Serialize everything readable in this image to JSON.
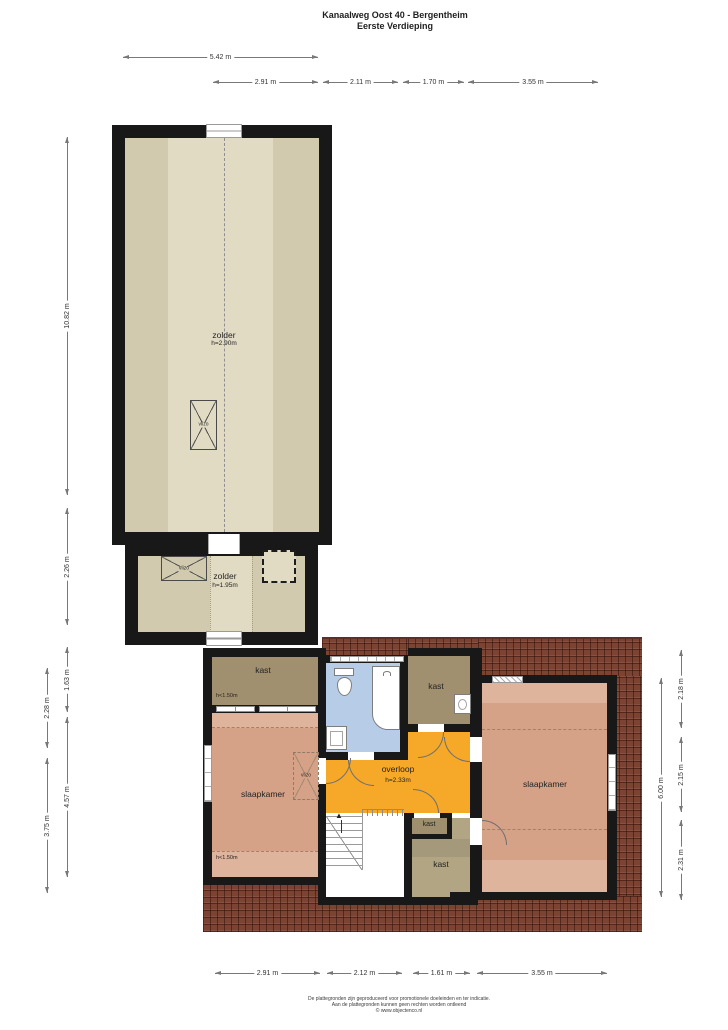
{
  "title": {
    "line1": "Kanaalweg Oost 40 - Bergentheim",
    "line2": "Eerste Verdieping"
  },
  "rooms": {
    "zolder_upper": {
      "label": "zolder",
      "height": "h=2.90m"
    },
    "zolder_lower": {
      "label": "zolder",
      "height": "h=1.95m"
    },
    "kast_nw": {
      "label": "kast",
      "height": "h<1.50m"
    },
    "slaapkamer_left": {
      "label": "slaapkamer",
      "height": "h<1.50m"
    },
    "kast_n": {
      "label": "kast"
    },
    "overloop": {
      "label": "overloop",
      "height": "h=2.33m"
    },
    "kast_mid": {
      "label": "kast"
    },
    "kast_s": {
      "label": "kast"
    },
    "slaapkamer_right": {
      "label": "slaapkamer"
    }
  },
  "hatches": {
    "upper": "vlizo",
    "lower": "vlizo",
    "bedroom": "vlizo"
  },
  "dims": {
    "top_total": "5.42 m",
    "top": [
      "2.91 m",
      "2.11 m",
      "1.70 m",
      "3.55 m"
    ],
    "left": [
      "10.82 m",
      "2.26 m",
      "1.63 m",
      "4.57 m"
    ],
    "left_outer": [
      "2.28 m",
      "3.75 m"
    ],
    "right_total": "6.00 m",
    "right_outer": [
      "2.18 m",
      "2.15 m",
      "2.31 m"
    ],
    "bottom": [
      "2.91 m",
      "2.12 m",
      "1.61 m",
      "3.55 m"
    ]
  },
  "footer": {
    "line1": "De plattegronden zijn geproduceerd voor promotionele doeleinden en ter indicatie.",
    "line2": "Aan de plattegronden kunnen geen rechten worden ontleend",
    "line3": "© www.objectenco.nl"
  },
  "colors": {
    "wall": "#181818",
    "attic_floor": "#e2dbc4",
    "attic_band": "#d2caae",
    "closet": "#a1906f",
    "closet_light": "#b1a584",
    "bedroom": "#d5a288",
    "bedroom_light": "#dfb49c",
    "landing": "#f6a928",
    "bathroom": "#b7cde7",
    "roof": "#7c4333"
  }
}
